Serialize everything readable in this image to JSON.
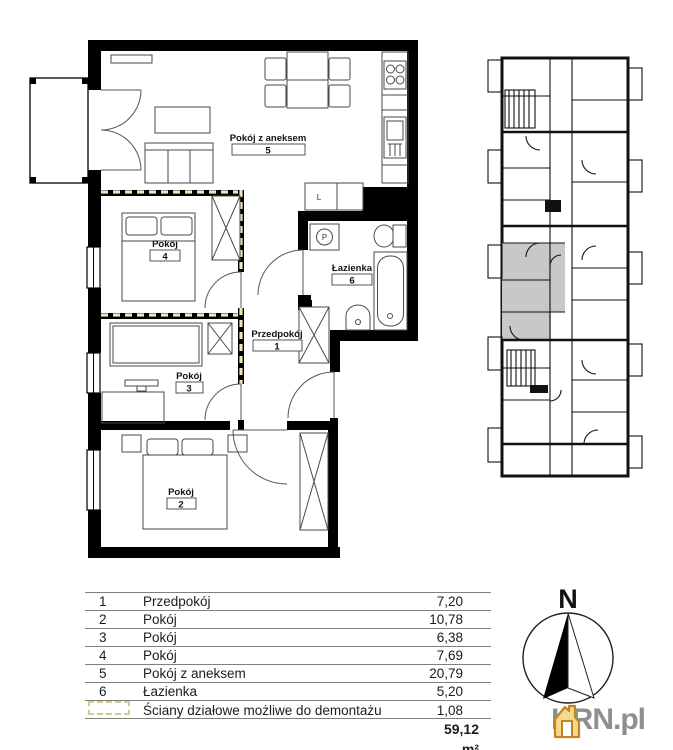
{
  "plan": {
    "room_labels": [
      {
        "name": "Pokój z aneksem",
        "number": "5"
      },
      {
        "name": "Pokój",
        "number": "4"
      },
      {
        "name": "Łazienka",
        "number": "6"
      },
      {
        "name": "Przedpokój",
        "number": "1"
      },
      {
        "name": "Pokój",
        "number": "3"
      },
      {
        "name": "Pokój",
        "number": "2"
      }
    ],
    "appliance_labels": {
      "fridge": "L",
      "washing_machine": "P"
    }
  },
  "area_table": {
    "rows": [
      {
        "no": "1",
        "name": "Przedpokój",
        "area": "7,20"
      },
      {
        "no": "2",
        "name": "Pokój",
        "area": "10,78"
      },
      {
        "no": "3",
        "name": "Pokój",
        "area": "6,38"
      },
      {
        "no": "4",
        "name": "Pokój",
        "area": "7,69"
      },
      {
        "no": "5",
        "name": "Pokój z aneksem",
        "area": "20,79"
      },
      {
        "no": "6",
        "name": "Łazienka",
        "area": "5,20"
      }
    ],
    "demountable_row": {
      "label": "Ściany działowe możliwe do demontażu",
      "area": "1,08"
    },
    "total_area": "59,12 m²"
  },
  "compass": {
    "north_label": "N"
  },
  "branding": {
    "site_name": "KRN.pl"
  },
  "colors": {
    "wall": "#000000",
    "demountable_dash": "#f0e4bc",
    "legend_dash": "#d6c98e",
    "highlight_unit": "#c8c8c8",
    "logo_orange": "#e9a93e",
    "logo_outline": "#bf861f",
    "logo_text_gray": "#8f8f8f"
  }
}
